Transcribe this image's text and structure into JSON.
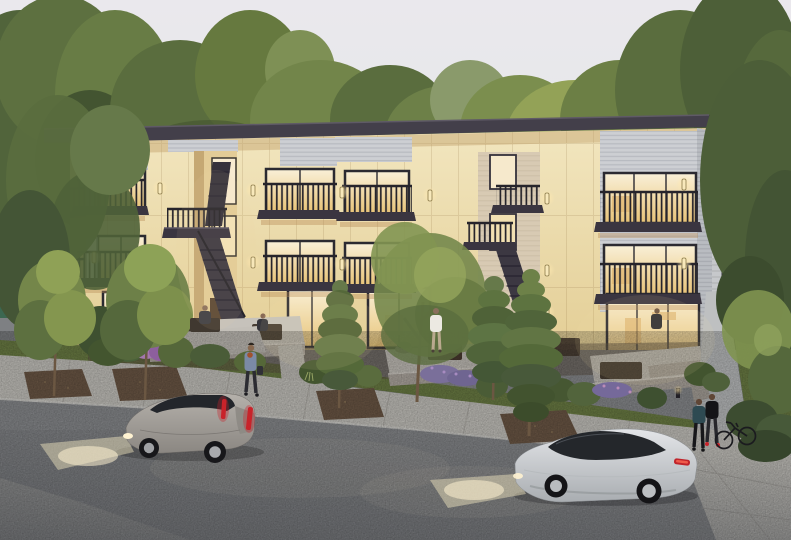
{
  "scene": {
    "type": "architectural-rendering",
    "setting": "dusk exterior view of a three-story apartment building with lit interiors, street, two moving cars and pedestrians",
    "building": {
      "floors": 3,
      "open_stairwells": 2,
      "front_balconies": 8,
      "lit_windows": true,
      "materials": [
        "cream stucco panels",
        "gray corrugated metal siding"
      ],
      "roof": "flat charcoal slab with wide overhang"
    },
    "vehicles": [
      {
        "name": "gray-coupe",
        "state": "driving left, headlights on"
      },
      {
        "name": "silver-sedan",
        "state": "driving left, headlights on"
      },
      {
        "name": "parked-minivan",
        "state": "parked in rear lot"
      }
    ],
    "people": [
      "pedestrian-with-bag-on-sidewalk",
      "man-standing-on-center-patio",
      "person-seated-at-stair-patio",
      "person-seated-on-left-patio",
      "person-at-right-patio",
      "couple-walking-with-bicycle"
    ],
    "landscape": [
      "background tree line",
      "street trees",
      "pine trees",
      "shrub beds",
      "lavender plantings",
      "lawn strip",
      "mulch tree pits"
    ],
    "structures": [
      "detached-garage",
      "green-waste-enclosure",
      "parking-stalls",
      "concrete-sidewalk",
      "asphalt-street",
      "patio-planter-walls"
    ]
  },
  "palette": {
    "sky_top": "#eae8ed",
    "sky_bottom": "#e2e6e5",
    "facade_top": "#f2e6bf",
    "facade_bottom": "#e2cc92",
    "facade_side": "#d9c28a",
    "roof": "#433f4a",
    "metal_panel": "#cdcfd3",
    "railing": "#26242b",
    "window_warm": "#f9f0d8",
    "window_deep": "#e8c377",
    "concrete": "#c9c7c1",
    "planter_wall": "#b2aba3",
    "asphalt": "#8b8d90",
    "lawn": "#6d7f45",
    "mulch": "#6e5947",
    "foliage_dark": "#445536",
    "foliage_mid": "#5d7340",
    "foliage_light": "#7d904c",
    "foliage_yellow": "#96a558",
    "car1_light": "#b5b1ab",
    "car1_dark": "#8b8782",
    "car2_light": "#e3e5e8",
    "car2_dark": "#a9adb1",
    "taillight": "#c8232a",
    "headlight_beam": "#f6ebc4",
    "shed_green": "#3c6751"
  }
}
